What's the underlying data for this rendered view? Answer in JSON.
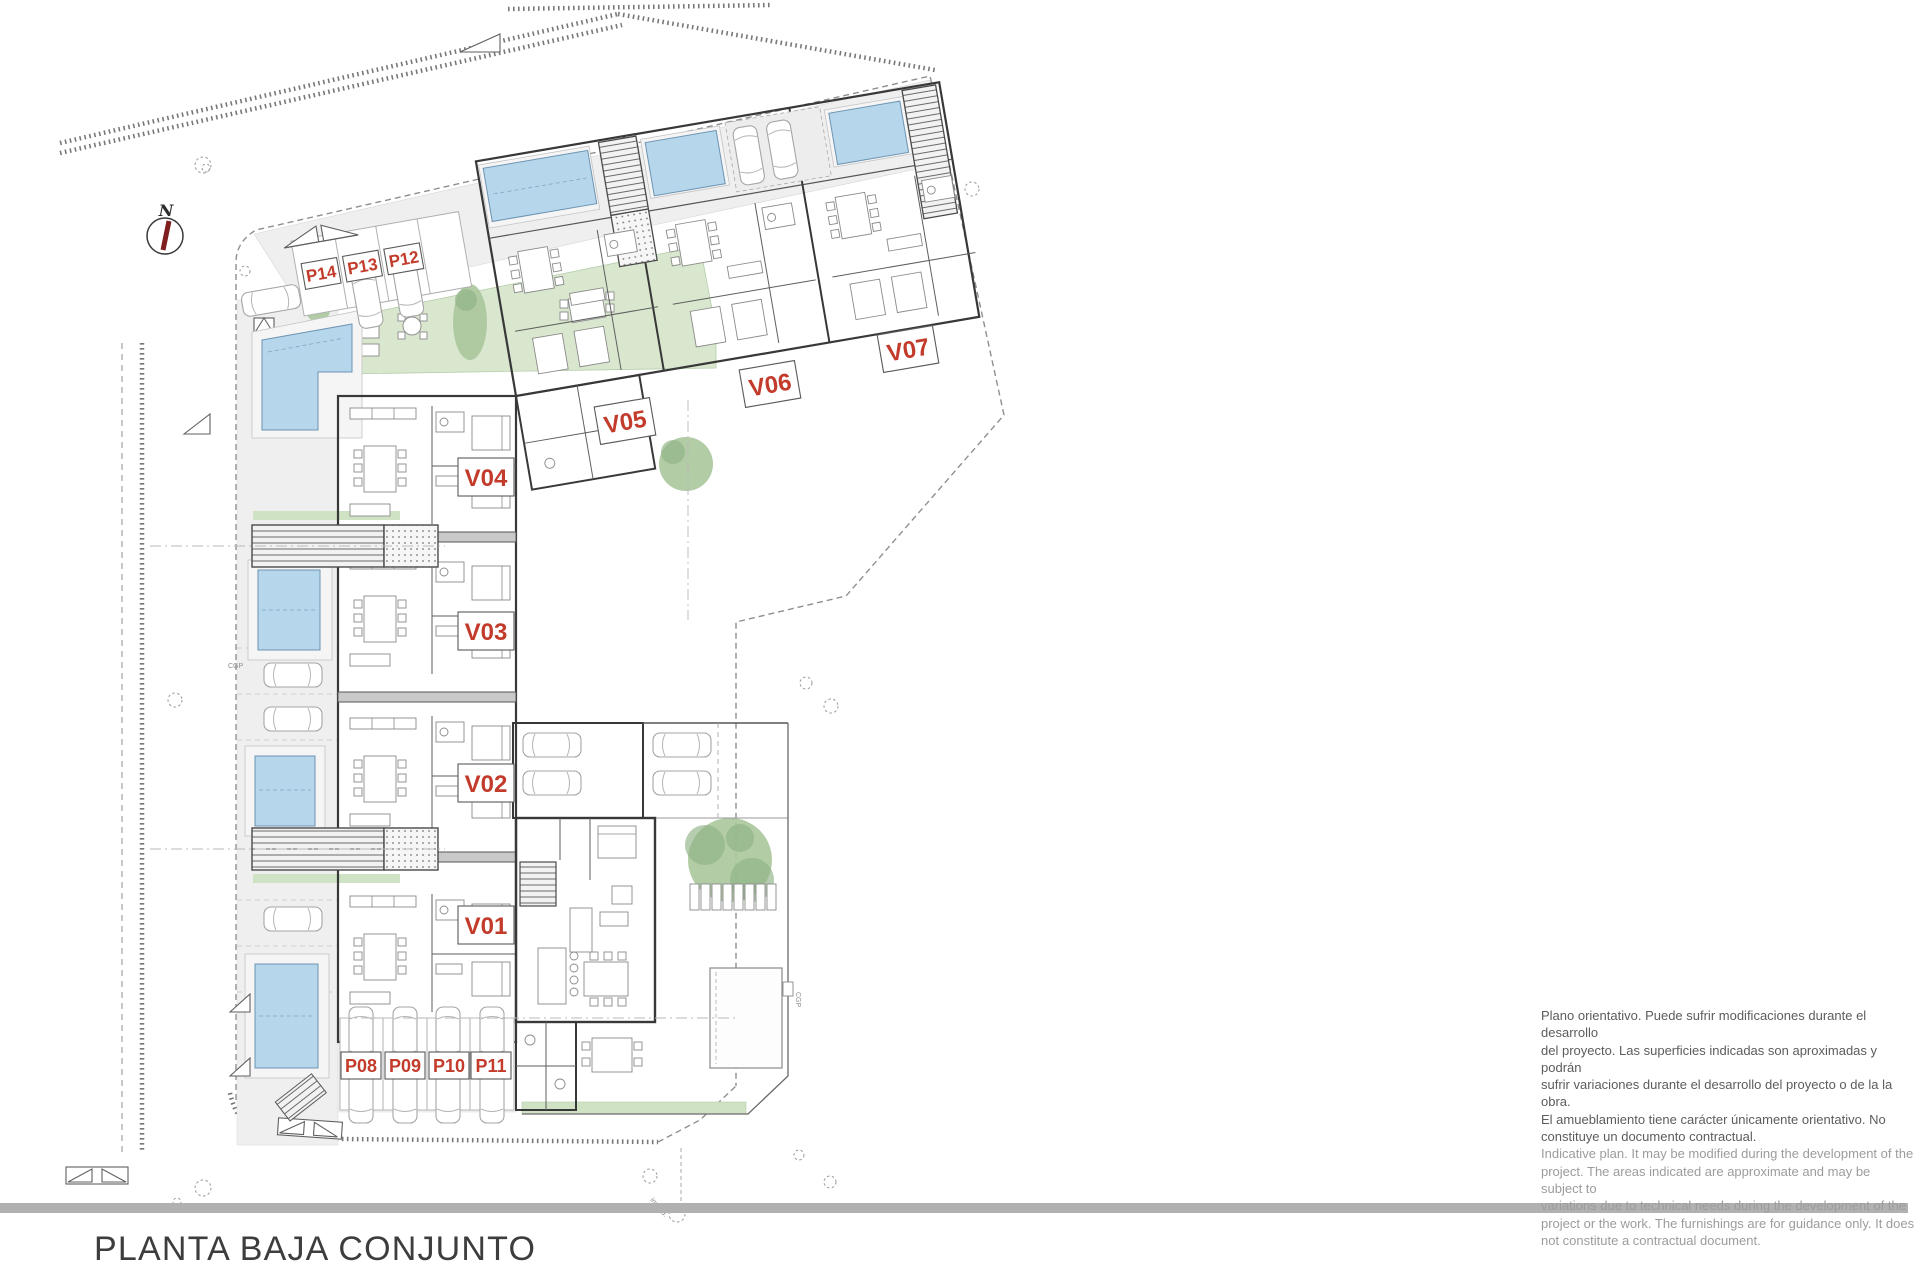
{
  "page": {
    "title": "PLANTA BAJA CONJUNTO"
  },
  "compass": {
    "label": "N"
  },
  "plan": {
    "unit_labels": {
      "v01": "V01",
      "v02": "V02",
      "v03": "V03",
      "v04": "V04",
      "v05": "V05",
      "v06": "V06",
      "v07": "V07"
    },
    "parking_labels": {
      "p08": "P08",
      "p09": "P09",
      "p10": "P10",
      "p11": "P11",
      "p12": "P12",
      "p13": "P13",
      "p14": "P14"
    },
    "tiny_labels": {
      "cgp_left": "CGP",
      "cgp_right": "CGP",
      "incend": "incend."
    }
  },
  "disclaimer": {
    "es_lines": [
      "Plano orientativo. Puede sufrir modificaciones durante el desarrollo",
      "del proyecto. Las superficies indicadas son aproximadas y podrán",
      "sufrir variaciones durante el desarrollo del proyecto o de la la obra.",
      "El amueblamiento tiene carácter únicamente orientativo. No",
      "constituye un documento contractual."
    ],
    "en_lines": [
      "Indicative plan. It may be modified during the development of the",
      "project. The areas indicated are approximate and may be subject to",
      "variations due to technical needs during the development of the",
      "project or the work. The furnishings are for guidance only. It does",
      "not constitute a contractual document."
    ]
  },
  "colors": {
    "label_red": "#c23b2b",
    "pool_blue": "#b5d6eb",
    "lawn_green": "#d9e7cf",
    "building_gray": "#dcdcdc",
    "bar_gray": "#b1b1b1"
  }
}
